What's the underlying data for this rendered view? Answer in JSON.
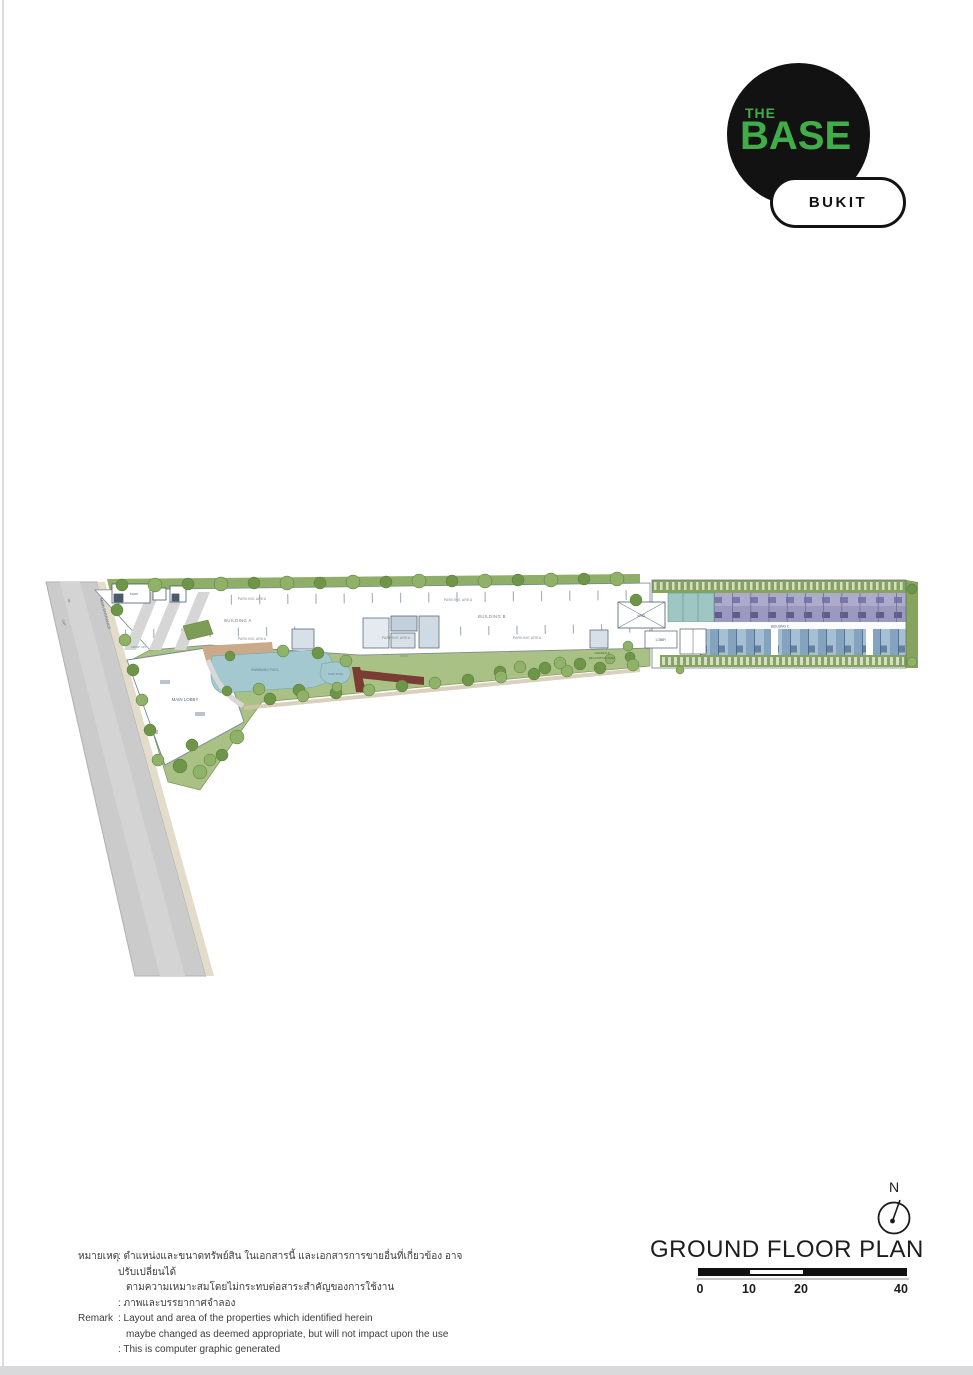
{
  "logo": {
    "brand_top": "THE",
    "brand_main": "BASE",
    "badge": "BUKIT",
    "green": "#3fae49",
    "black": "#121212"
  },
  "plan": {
    "labels": {
      "building_a": "BUILDING A",
      "building_b": "BUILDING B",
      "building_c": "BUILDING C",
      "parking": "PARKING AREA",
      "main_lobby": "MAIN LOBBY",
      "main_entrance": "MAIN ENTRANCE",
      "in": "IN",
      "out": "OUT",
      "drop_off": "DROP OFF",
      "swimming_pool": "SWIMMING POOL",
      "kids_pool": "KIDS POOL",
      "garden_line1": "GARDEN &",
      "garden_line2": "RELAXATION AREA",
      "void": "VOID",
      "lobby": "LOBBY",
      "shop": "SHOP",
      "ramp": "RAMP"
    },
    "colors": {
      "road_gray": "#cbcbcb",
      "landscape_green": "#8fae68",
      "pool_blue": "#a3c8d0",
      "units_purple": "#9b99bf",
      "units_blue": "#84a3bf",
      "units_teal": "#9ec6c2",
      "accent_red": "#7b3c33"
    }
  },
  "title_block": {
    "title": "GROUND FLOOR PLAN",
    "north_label": "N",
    "scale_ticks": [
      "0",
      "10",
      "20",
      "40"
    ]
  },
  "remark": {
    "thai_label": "หมายเหตุ",
    "thai_line1": ": ตำแหน่งและขนาดทรัพย์สิน ในเอกสารนี้ และเอกสารการขายอื่นที่เกี่ยวข้อง อาจปรับเปลี่ยนได้",
    "thai_line2": "ตามความเหมาะสมโดยไม่กระทบต่อสาระสำคัญของการใช้งาน",
    "thai_line3": ": ภาพและบรรยากาศจำลอง",
    "en_label": "Remark",
    "en_line1": ": Layout and area of the properties which identified herein",
    "en_line2": "maybe changed as deemed appropriate, but will not impact upon the use",
    "en_line3": ": This is computer graphic generated"
  }
}
